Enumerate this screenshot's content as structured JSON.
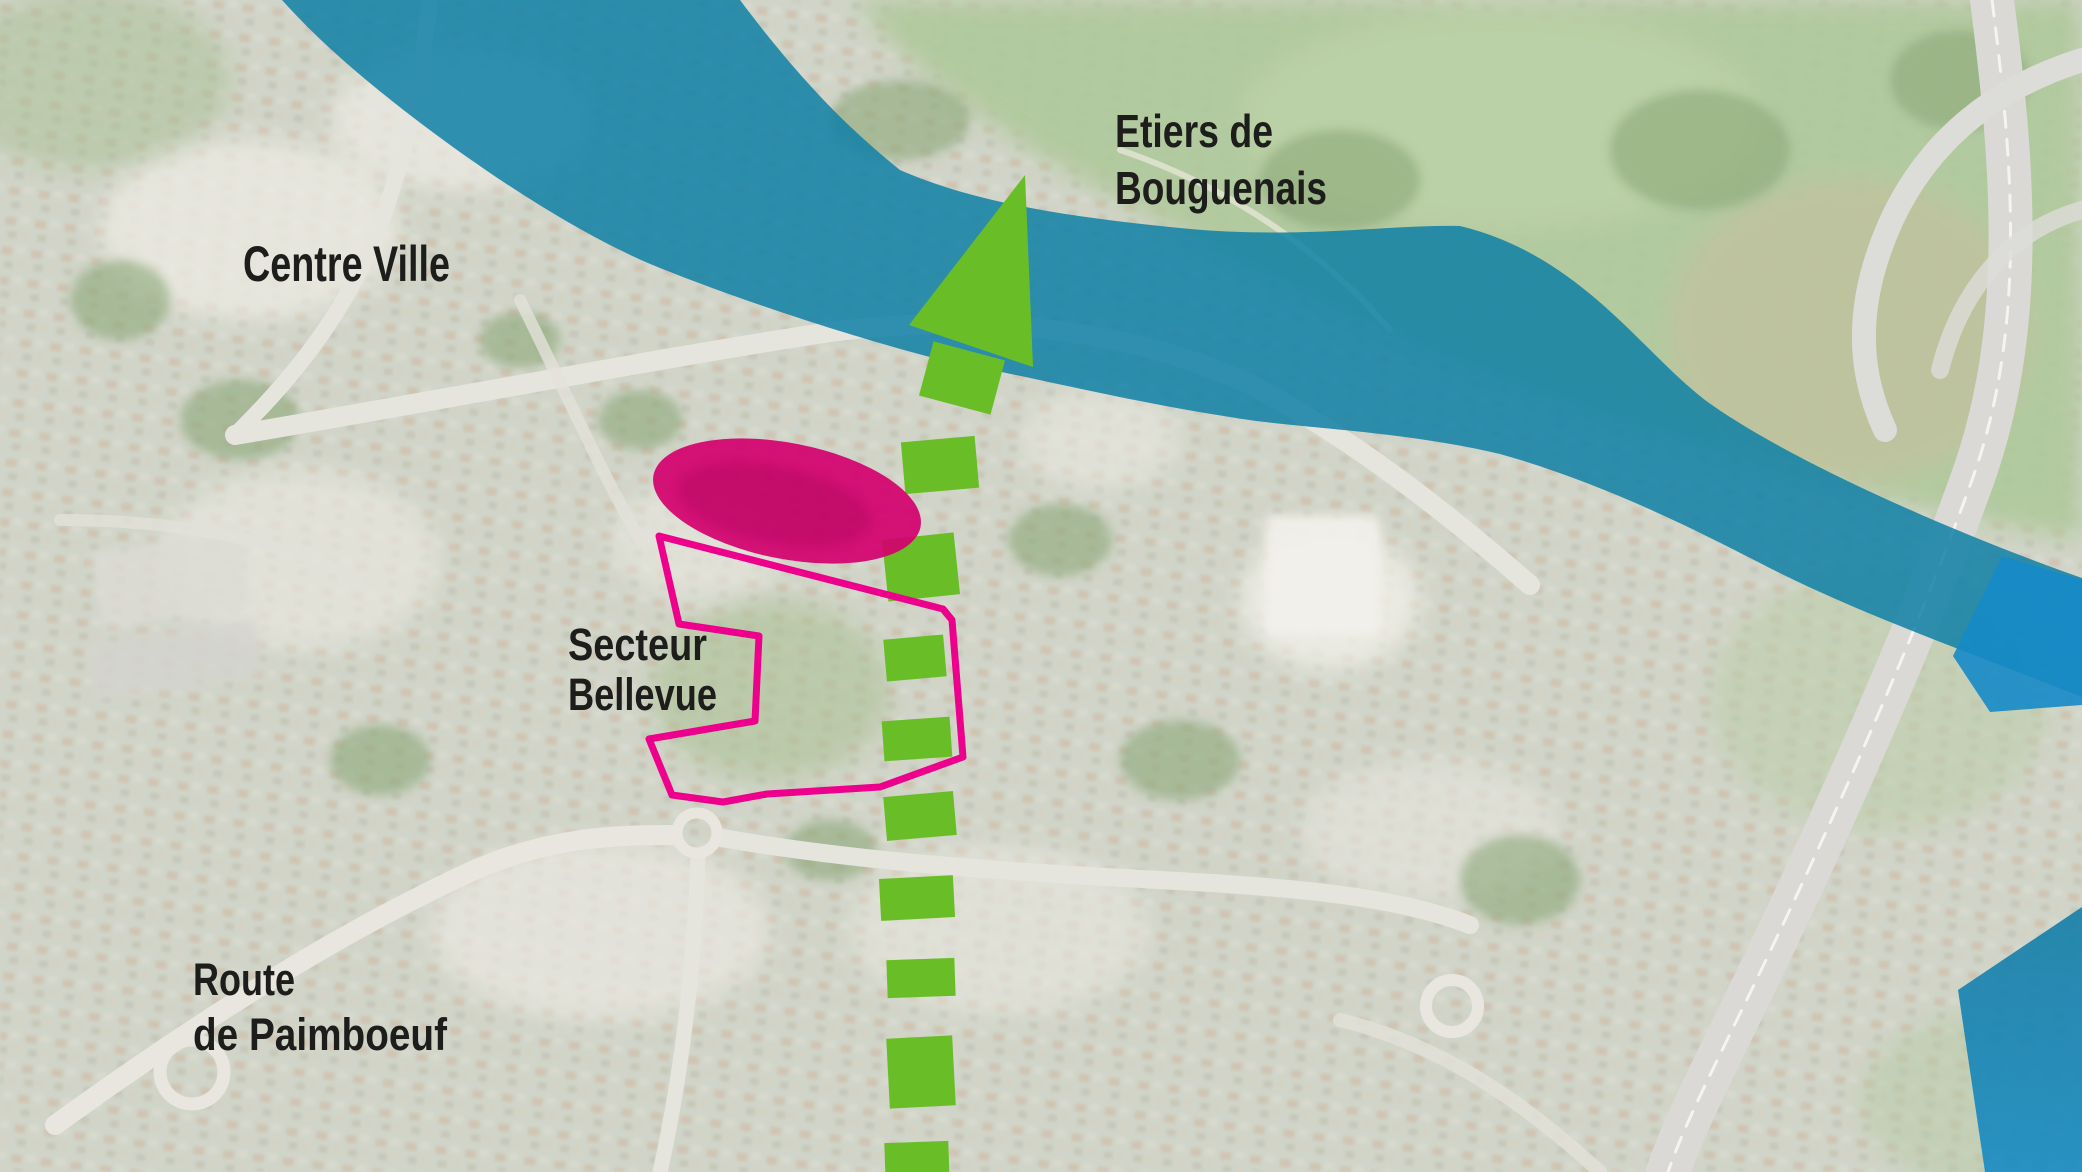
{
  "map": {
    "labels": {
      "centre_ville": "Centre Ville",
      "etiers_line1": "Etiers de",
      "etiers_line2": "Bouguenais",
      "secteur_line1": "Secteur",
      "secteur_line2": "Bellevue",
      "route_line1": "Route",
      "route_line2": "de Paimboeuf"
    }
  },
  "colors": {
    "green": "#69be28",
    "pink": "#ec008c",
    "magenta": "#d4006e",
    "teal": "#0f80a6",
    "blue": "#1689c8",
    "label": "#1d1d1b"
  }
}
